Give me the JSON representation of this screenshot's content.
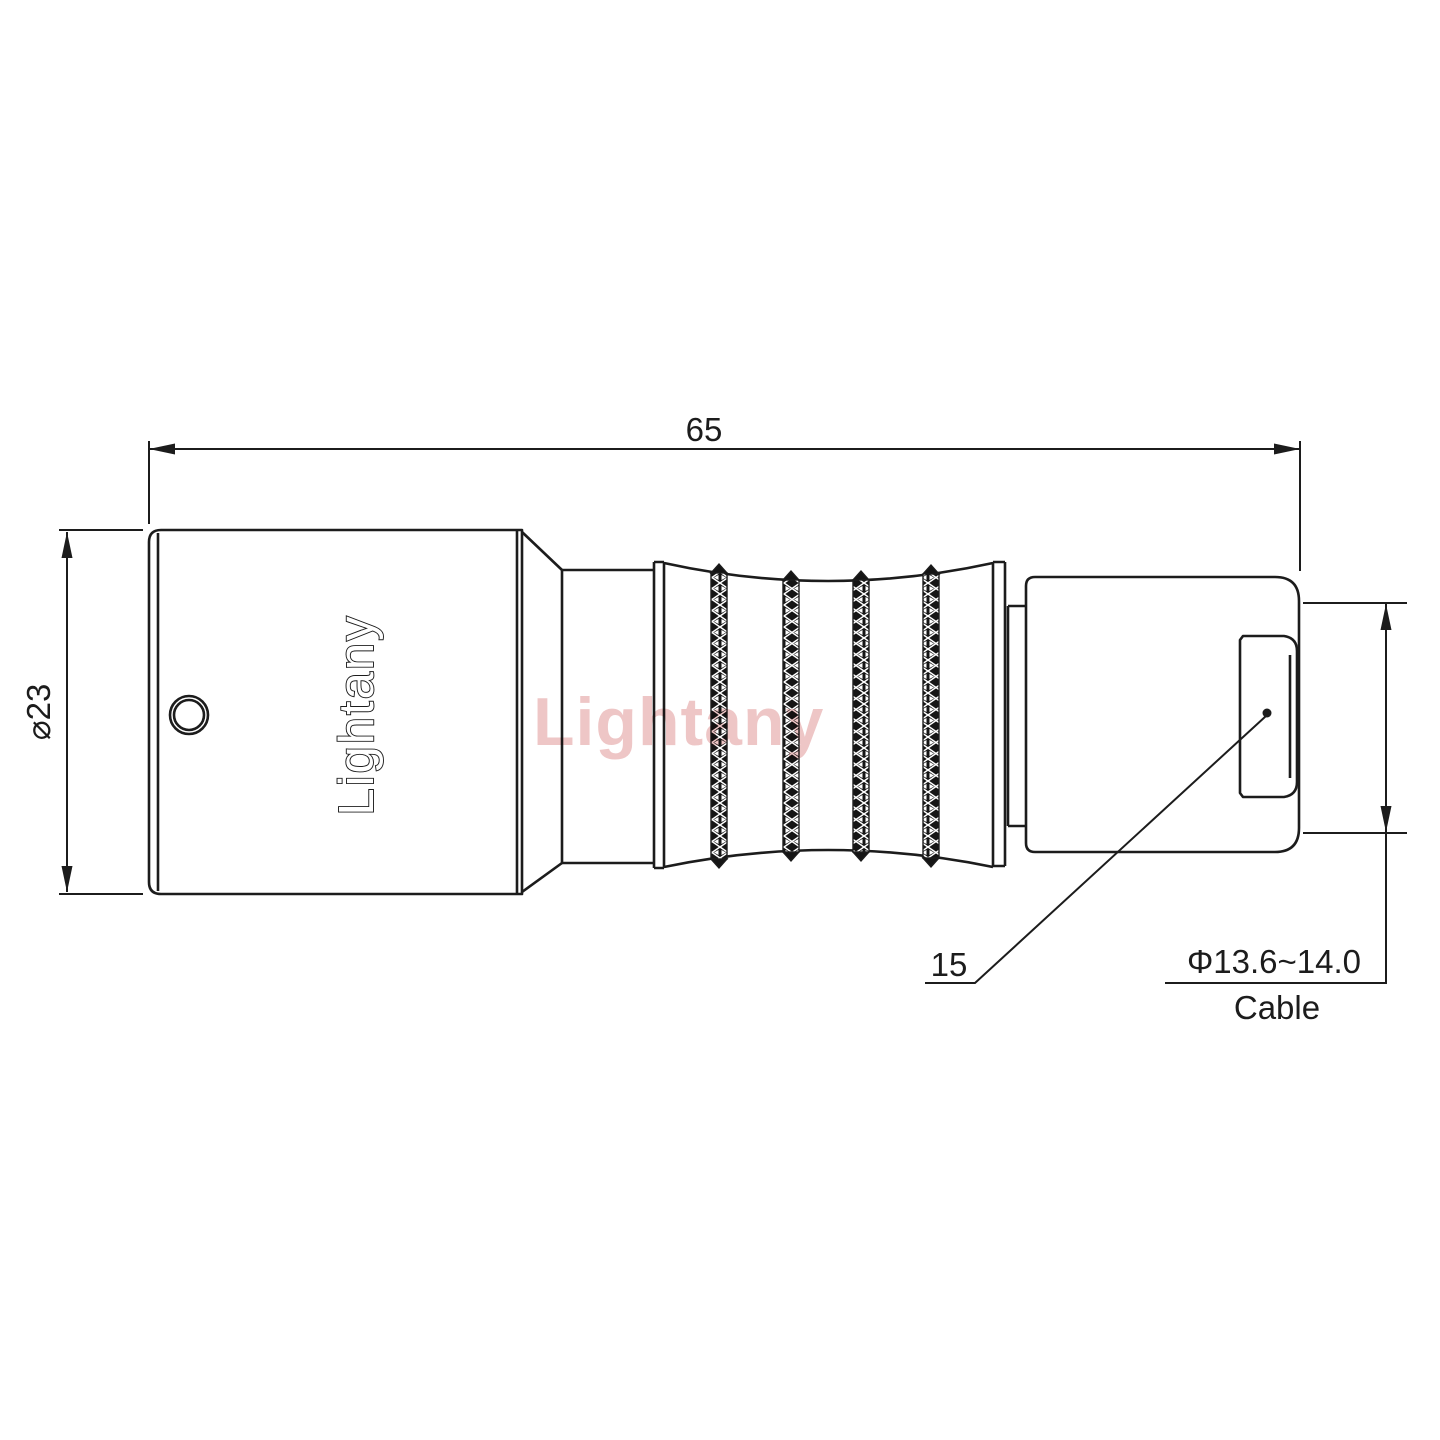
{
  "drawing": {
    "type": "technical-drawing-connector-side-view",
    "line_color": "#1c1c1c",
    "background_color": "#ffffff",
    "logo_text": "Lightany",
    "watermark": {
      "text": "Lightany",
      "color": "#cc5858"
    },
    "dimensions": {
      "overall_length": {
        "value": "65"
      },
      "body_diameter": {
        "value": "⌀23"
      },
      "nut_length": {
        "value": "15"
      },
      "cable_diameter": {
        "value": "Φ13.6~14.0"
      },
      "cable_label": {
        "value": "Cable"
      }
    }
  }
}
